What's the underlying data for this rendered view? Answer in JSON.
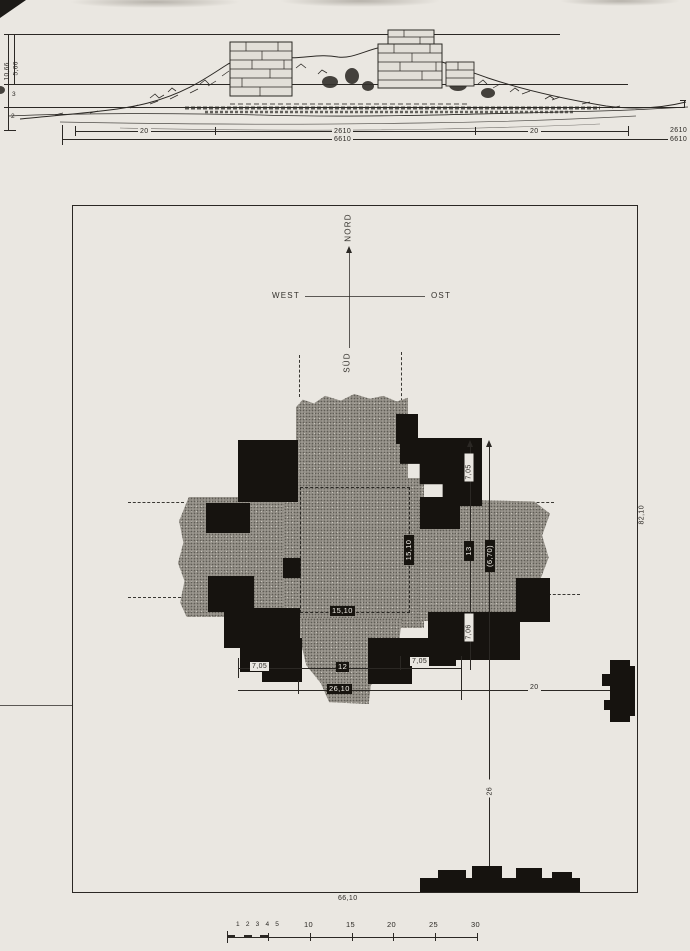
{
  "elevation": {
    "left_dims": {
      "outer": "10,66",
      "inner": "5,66",
      "mid": "3",
      "low": "2"
    },
    "bottom_dims": {
      "seg_left": "20",
      "seg_center": "2610",
      "seg_right": "20",
      "total": "6610",
      "edge_center_repeat": "2610",
      "edge_total_repeat": "6610"
    }
  },
  "compass": {
    "north": "NORD",
    "west": "WEST",
    "east": "OST",
    "south": "SÜD"
  },
  "plan": {
    "border_height_dim": "82,10",
    "border_width_dim": "66,10",
    "inner_square_bottom": "15,10",
    "inner_square_right": "15,10",
    "v_dim_top": "7,05",
    "v_dim_mid": "13",
    "v_dim_mid_paren": "(6,70)",
    "v_dim_bottom": "7,06",
    "v_dim_lower": "26",
    "h_dim_left": "7,05",
    "h_dim_center": "12",
    "h_dim_right": "7,05",
    "h_dim_total": "26,10",
    "h_dim_east_offset": "20"
  },
  "scale_bar": {
    "minor_labels": "1 2 3 4 5",
    "majors": [
      "10",
      "15",
      "20",
      "25",
      "30"
    ]
  },
  "colors": {
    "paper": "#eae7e1",
    "ink": "#2b2824",
    "wall_black": "#16130f",
    "fill_gray": "#9a968e"
  }
}
